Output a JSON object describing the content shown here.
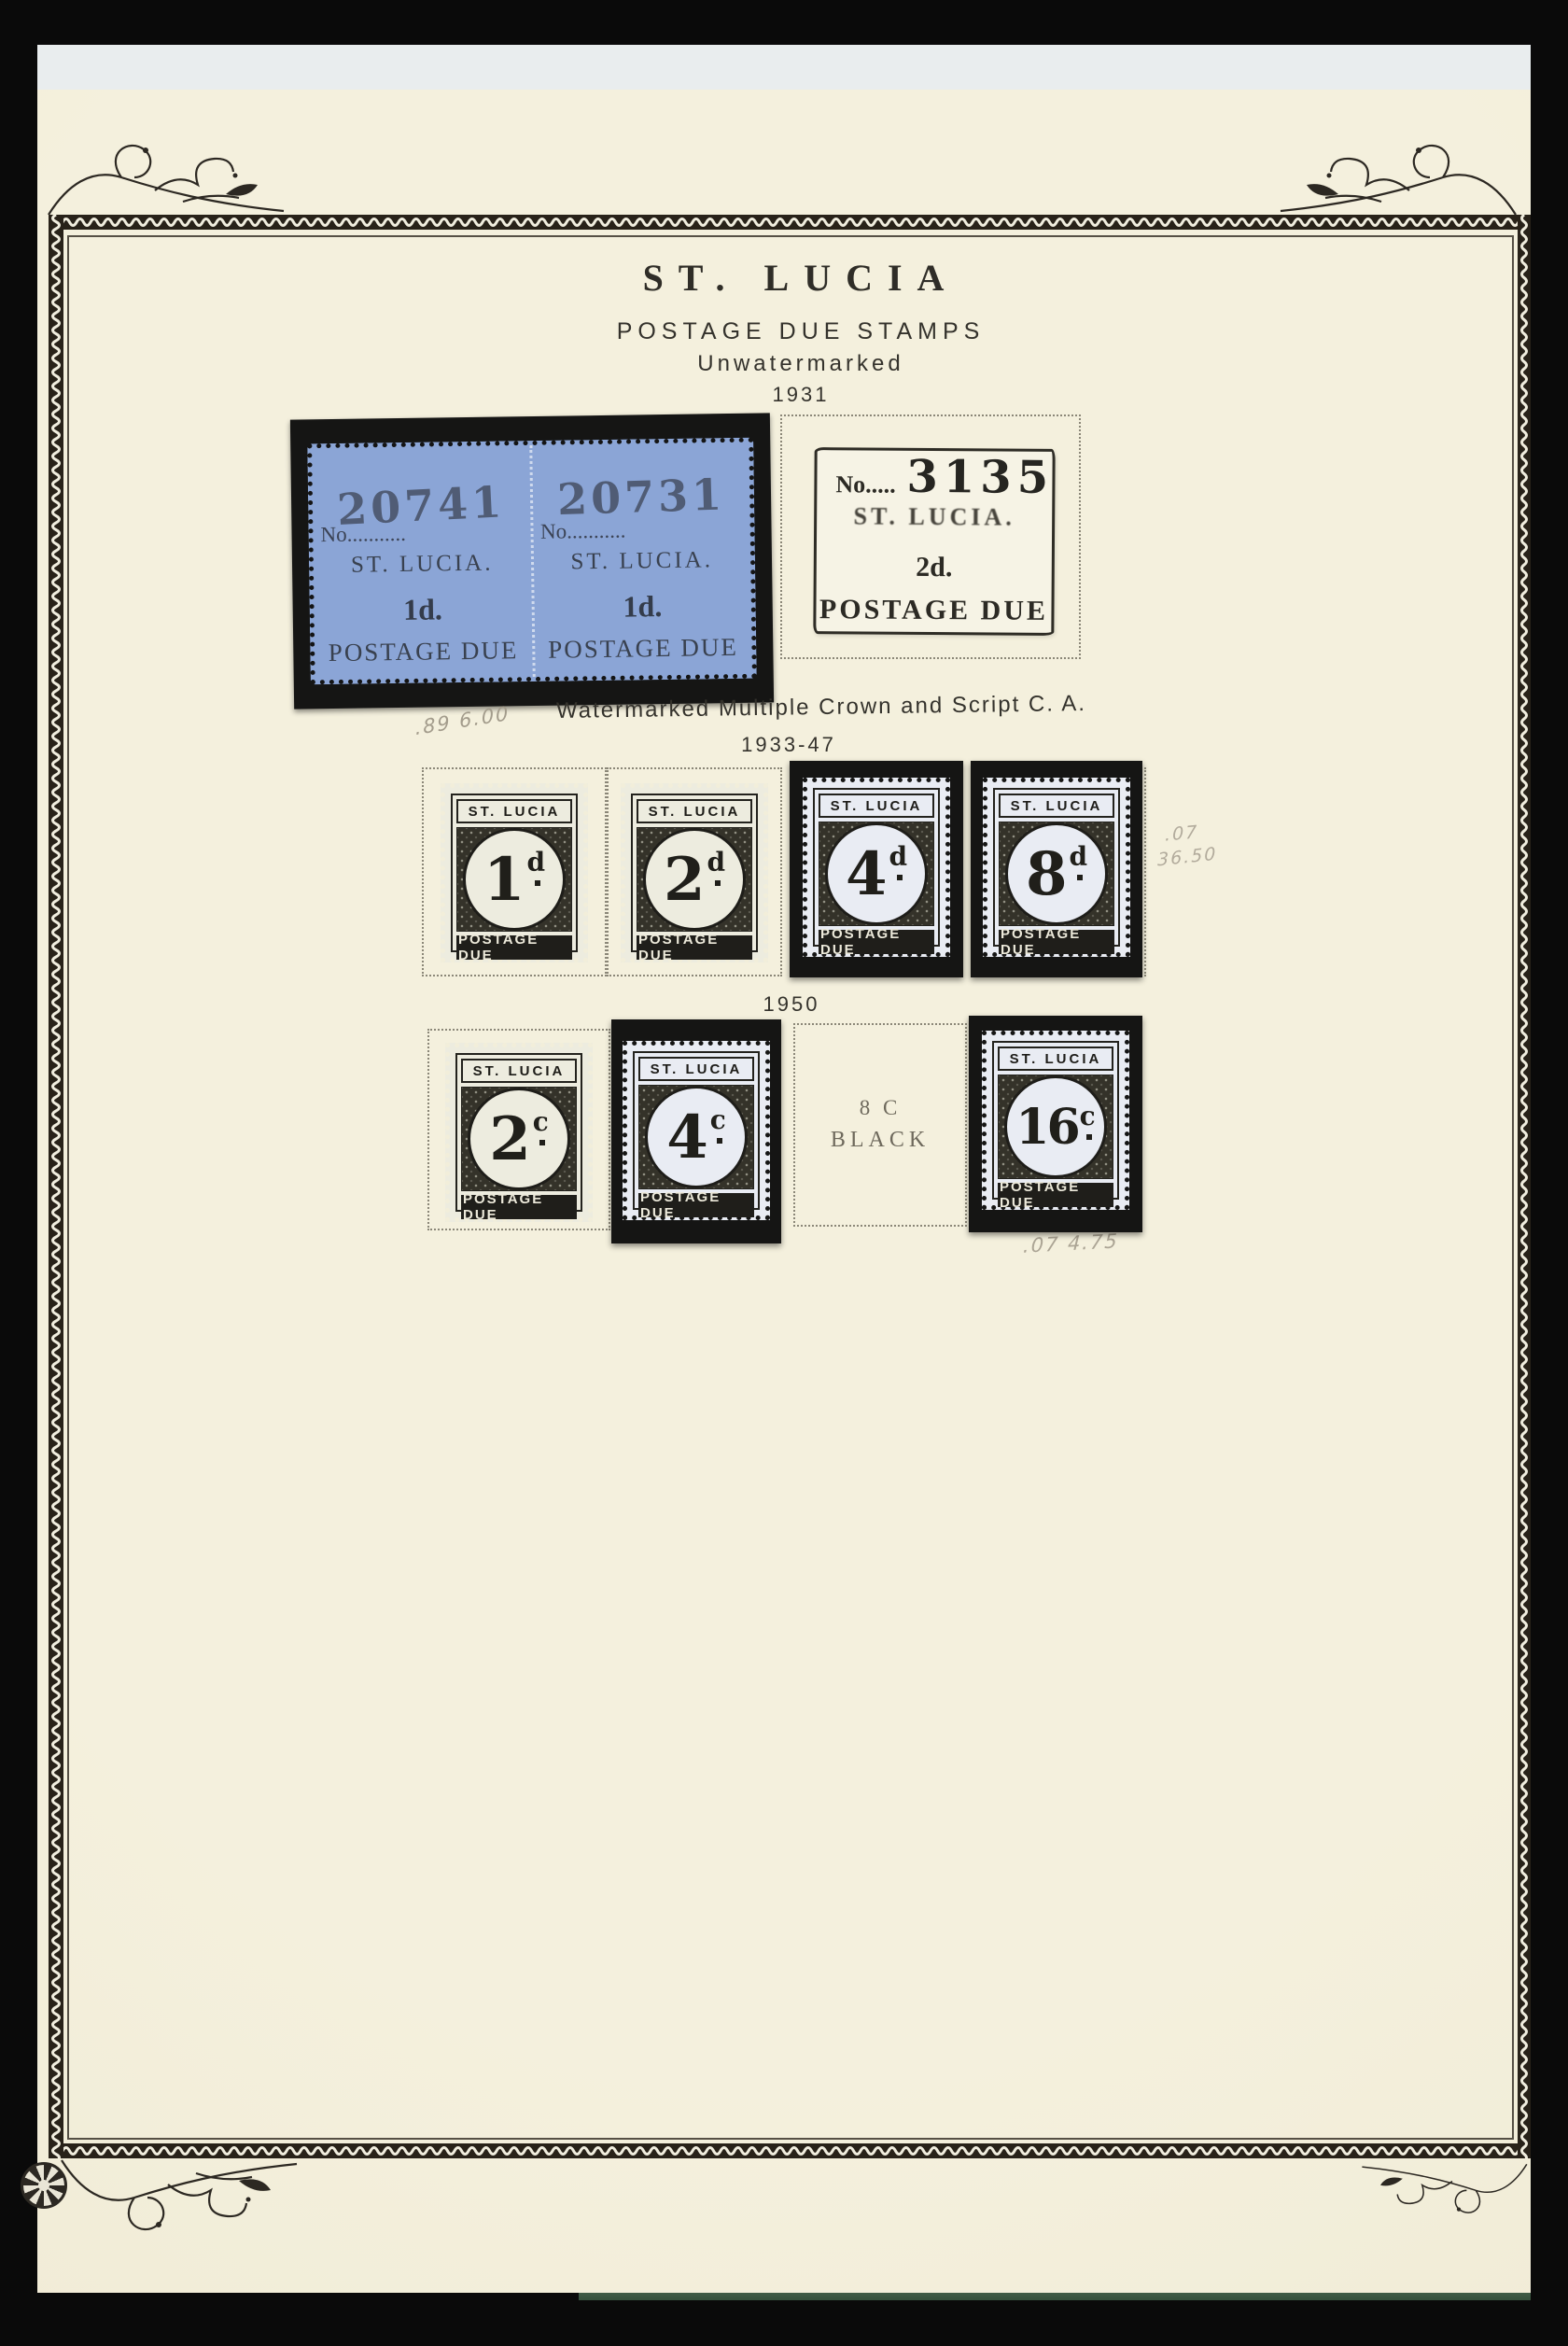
{
  "header": {
    "country_title": "ST. LUCIA",
    "section_title": "POSTAGE DUE STAMPS",
    "watermark_state": "Unwatermarked",
    "year": "1931"
  },
  "watermarked_section": {
    "note": "Watermarked Multiple Crown and Script C. A.",
    "years": "1933-47"
  },
  "fifties_section": {
    "year": "1950"
  },
  "blue_pair": {
    "left": {
      "no_line": "No...........",
      "serial": "20741",
      "country": "ST. LUCIA.",
      "value": "1d.",
      "footer": "POSTAGE DUE"
    },
    "right": {
      "no_line": "No...........",
      "serial": "20731",
      "country": "ST. LUCIA.",
      "value": "1d.",
      "footer": "POSTAGE DUE"
    }
  },
  "stamp_3135": {
    "no_line": "No.....",
    "serial": "3135",
    "country": "ST. LUCIA.",
    "value": "2d.",
    "footer": "POSTAGE DUE"
  },
  "definitive_labels": {
    "country": "ST. LUCIA",
    "footer": "POSTAGE DUE"
  },
  "series_1933_47": [
    {
      "numeral": "1",
      "unit": "d"
    },
    {
      "numeral": "2",
      "unit": "d"
    },
    {
      "numeral": "4",
      "unit": "d"
    },
    {
      "numeral": "8",
      "unit": "d"
    }
  ],
  "series_1950": [
    {
      "numeral": "2",
      "unit": "c"
    },
    {
      "numeral": "4",
      "unit": "c"
    },
    {
      "numeral": "16",
      "unit": "c"
    }
  ],
  "missing_stamp_8c": {
    "line1": "8 C",
    "line2": "BLACK"
  },
  "pencil_notes": {
    "below_blue_pair": ".89 6.00",
    "right_of_8d_line1": ".07",
    "right_of_8d_line2": "36.50",
    "below_16c": ".07 4.75"
  }
}
